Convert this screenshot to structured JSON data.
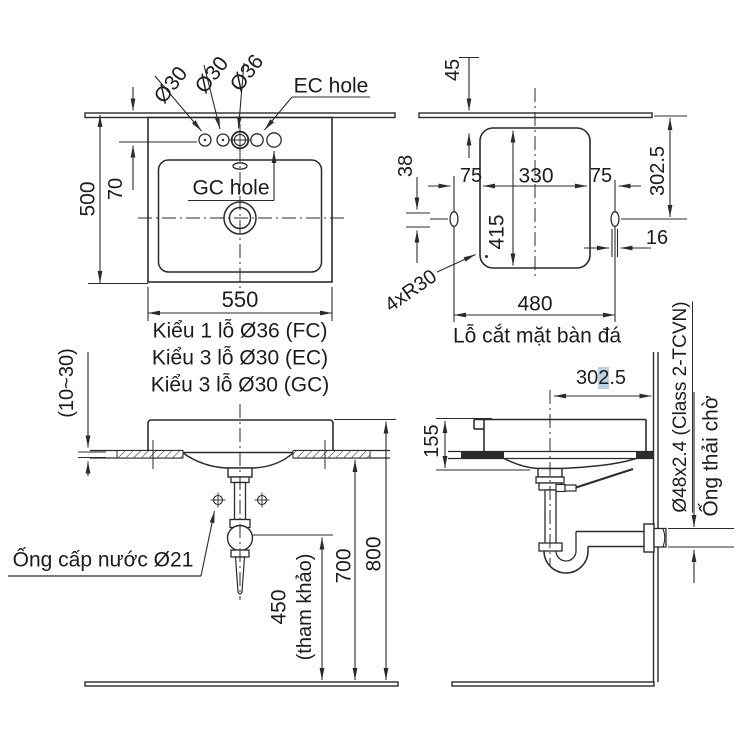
{
  "colors": {
    "line": "#2b2b2b",
    "text": "#1c1c1c",
    "highlight": "#b9d2e6",
    "paper": "#ffffff"
  },
  "top_view": {
    "hole_labels": {
      "left": "Ø30",
      "middle": "Ø30",
      "center": "Ø36",
      "ec": "EC hole",
      "gc": "GC hole"
    },
    "dims": {
      "overall_depth": "500",
      "hole_offset": "70",
      "overall_width": "550"
    },
    "notes": [
      "Kiểu 1 lỗ Ø36 (FC)",
      "Kiểu 3 lỗ Ø30 (EC)",
      "Kiểu 3 lỗ Ø30 (GC)"
    ]
  },
  "cutout_view": {
    "dims": {
      "front_offset": "45",
      "slot_height": "38",
      "left_margin": "75",
      "inner_width": "330",
      "right_margin": "75",
      "inner_height": "415",
      "rear_offset": "302.5",
      "wall_gap": "16",
      "hole_span": "480",
      "corner_note": "4xR30"
    },
    "caption": "Lỗ cắt mặt bàn đá"
  },
  "side_view": {
    "dims": {
      "counter_thickness": "(10~30)",
      "supply_height": "450",
      "supply_height_note": "(tham khảo)",
      "counter_height": "700",
      "rim_height": "800"
    },
    "supply_label": "Ống cấp nước Ø21"
  },
  "wall_view": {
    "dims": {
      "basin_height": "155",
      "drain_offset": {
        "pre": "30",
        "highlight": "2",
        "post": ".5"
      }
    },
    "drain_pipe_label": "Ø48x2.4 (Class 2-TCVN)",
    "waste_pipe_label": "Ống thải chờ"
  }
}
